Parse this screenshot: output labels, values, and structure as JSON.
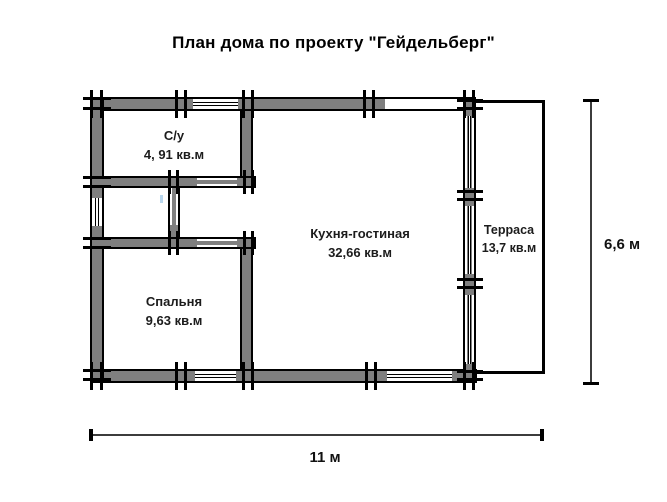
{
  "title": "План дома по проекту \"Гейдельберг\"",
  "rooms": [
    {
      "name": "С/у",
      "area": "4, 91 кв.м"
    },
    {
      "name": "Спальня",
      "area": "9,63 кв.м"
    },
    {
      "name": "Кухня-гостиная",
      "area": "32,66 кв.м"
    },
    {
      "name": "Терраса",
      "area": "13,7 кв.м"
    }
  ],
  "dimensions": {
    "total_width": "11 м",
    "total_height": "6,6 м"
  },
  "colors": {
    "wall_fill": "#7f7f7f",
    "outline": "#000000",
    "background": "#ffffff"
  }
}
